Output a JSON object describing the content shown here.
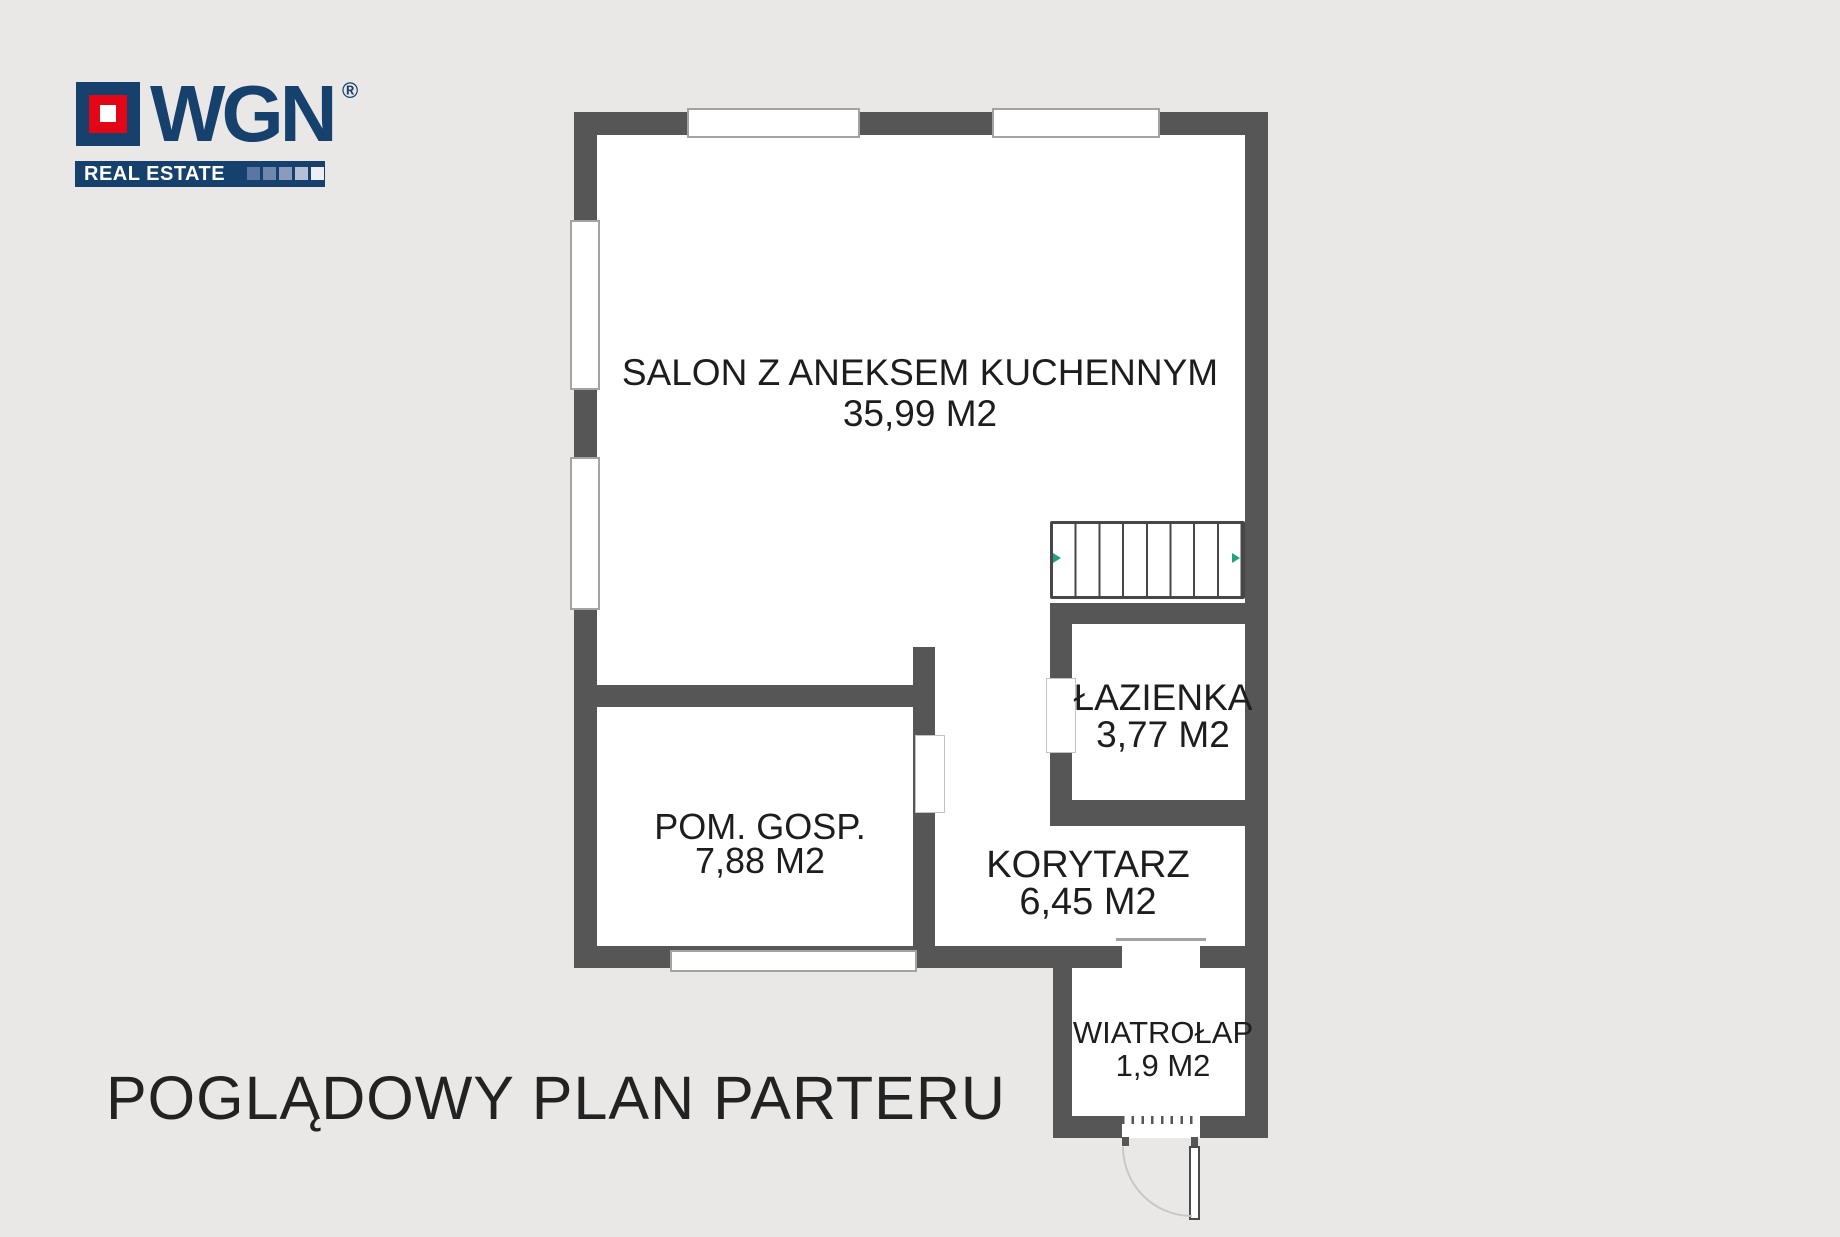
{
  "logo": {
    "brand": "WGN",
    "registered": "®",
    "banner": "REAL ESTATE",
    "colors": {
      "navy": "#17416d",
      "red": "#e30617",
      "gradient_squares": [
        "#5a76a2",
        "#6f86ad",
        "#8a9bbd",
        "#b5c0d4",
        "#eceff4"
      ]
    }
  },
  "plan": {
    "rooms": [
      {
        "id": "salon",
        "name": "SALON Z ANEKSEM KUCHENNYM",
        "area": "35,99 M2"
      },
      {
        "id": "pom-gosp",
        "name": "POM. GOSP.",
        "area": "7,88 M2"
      },
      {
        "id": "lazienka",
        "name": "ŁAZIENKA",
        "area": "3,77 M2"
      },
      {
        "id": "korytarz",
        "name": "KORYTARZ",
        "area": "6,45 M2"
      },
      {
        "id": "wiatrolap",
        "name": "WIATROŁAP",
        "area": "1,9 M2"
      }
    ],
    "colors": {
      "wall": "#565656",
      "floor": "#ffffff",
      "background": "#e9e8e7",
      "window_frame": "#a3a3a2",
      "stairs_arrow": "#23a07c",
      "door_arc": "#c7c7c6",
      "text": "#1d1d1d"
    },
    "features": {
      "stairs_treads": 8,
      "windows": 5,
      "entrance_door": 1
    }
  },
  "caption": "POGLĄDOWY PLAN PARTERU"
}
